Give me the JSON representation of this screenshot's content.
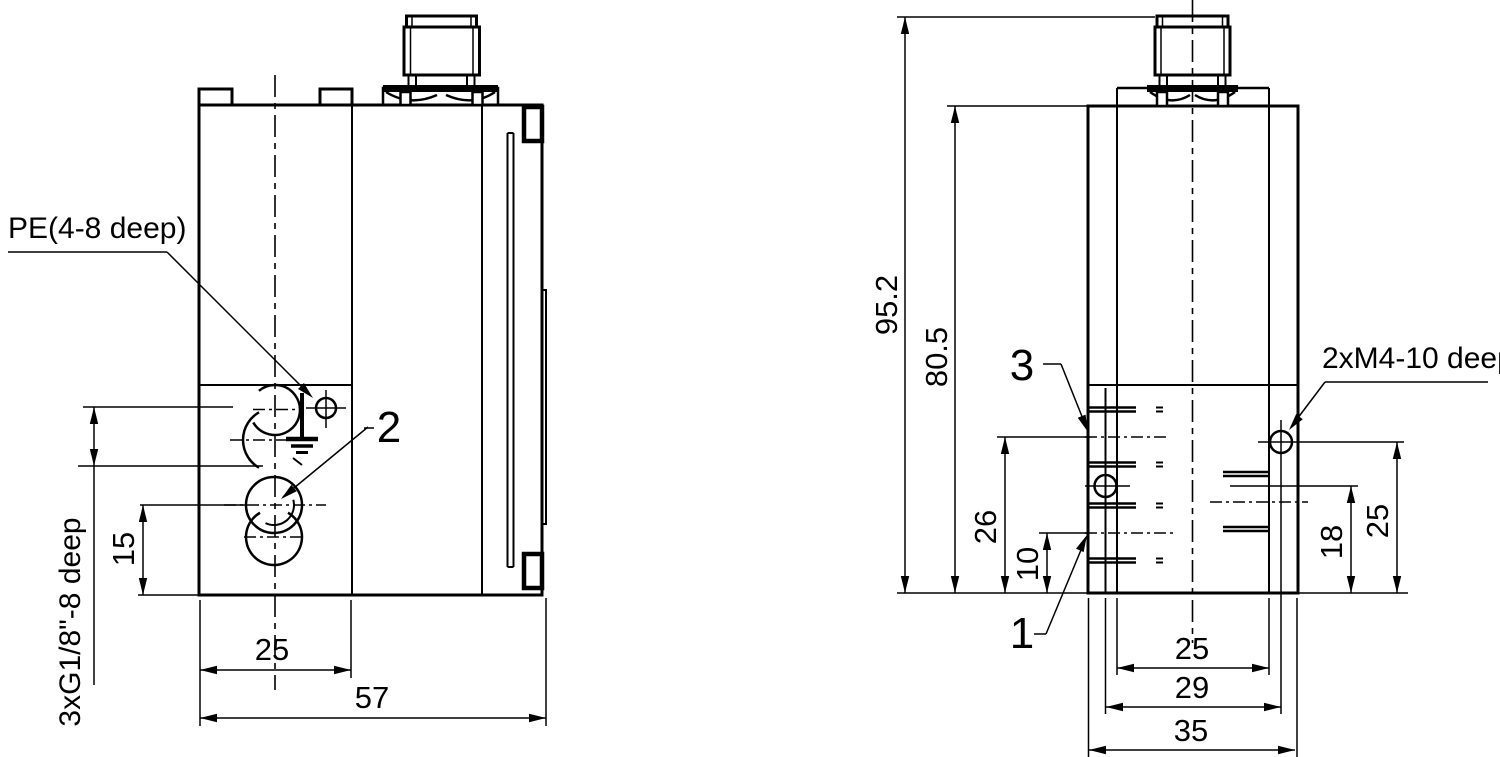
{
  "side_view": {
    "pe_callout": "PE(4-8 deep)",
    "thread_callout": "3xG1/8\"-8 deep",
    "item_2": "2",
    "dim_port_height": "15",
    "dim_front_width": "25",
    "dim_depth": "57"
  },
  "front_view": {
    "m4_callout": "2xM4-10 deep",
    "item_3": "3",
    "item_1": "1",
    "dim_total_height": "95.2",
    "dim_body_height": "80.5",
    "dim_port_a_height": "26",
    "dim_port_b_height": "10",
    "dim_hole_left_height": "18",
    "dim_hole_right_height": "25",
    "dim_holes_inner_width": "25",
    "dim_holes_span": "29",
    "dim_body_width": "35"
  },
  "colors": {
    "line": "#000000",
    "background": "#ffffff"
  }
}
